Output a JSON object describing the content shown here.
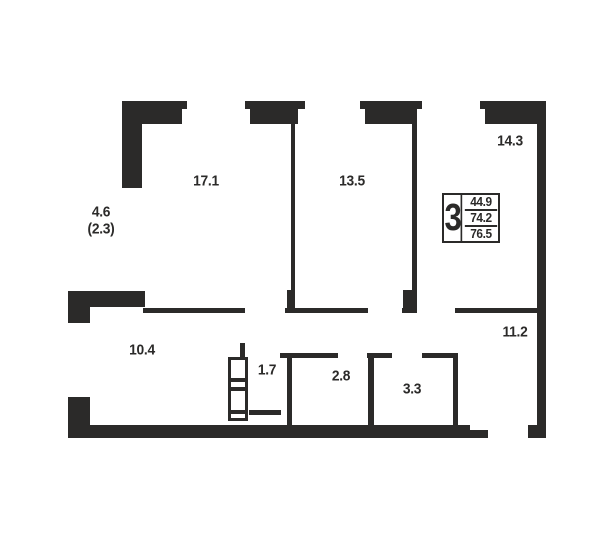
{
  "floor_plan": {
    "ink_color": "#2b2a29",
    "rooms": [
      {
        "id": "room-17-1",
        "area": "17.1"
      },
      {
        "id": "room-13-5",
        "area": "13.5"
      },
      {
        "id": "room-14-3",
        "area": "14.3"
      },
      {
        "id": "corridor-10-4",
        "area": "10.4"
      },
      {
        "id": "closet-1-7",
        "area": "1.7"
      },
      {
        "id": "room-2-8",
        "area": "2.8"
      },
      {
        "id": "room-3-3",
        "area": "3.3"
      },
      {
        "id": "hall-11-2",
        "area": "11.2"
      },
      {
        "id": "balcony",
        "area": "4.6",
        "area_reduced": "(2.3)"
      }
    ],
    "summary_box": {
      "rooms_count": "3",
      "row_values": [
        "44.9",
        "74.2",
        "76.5"
      ]
    }
  }
}
